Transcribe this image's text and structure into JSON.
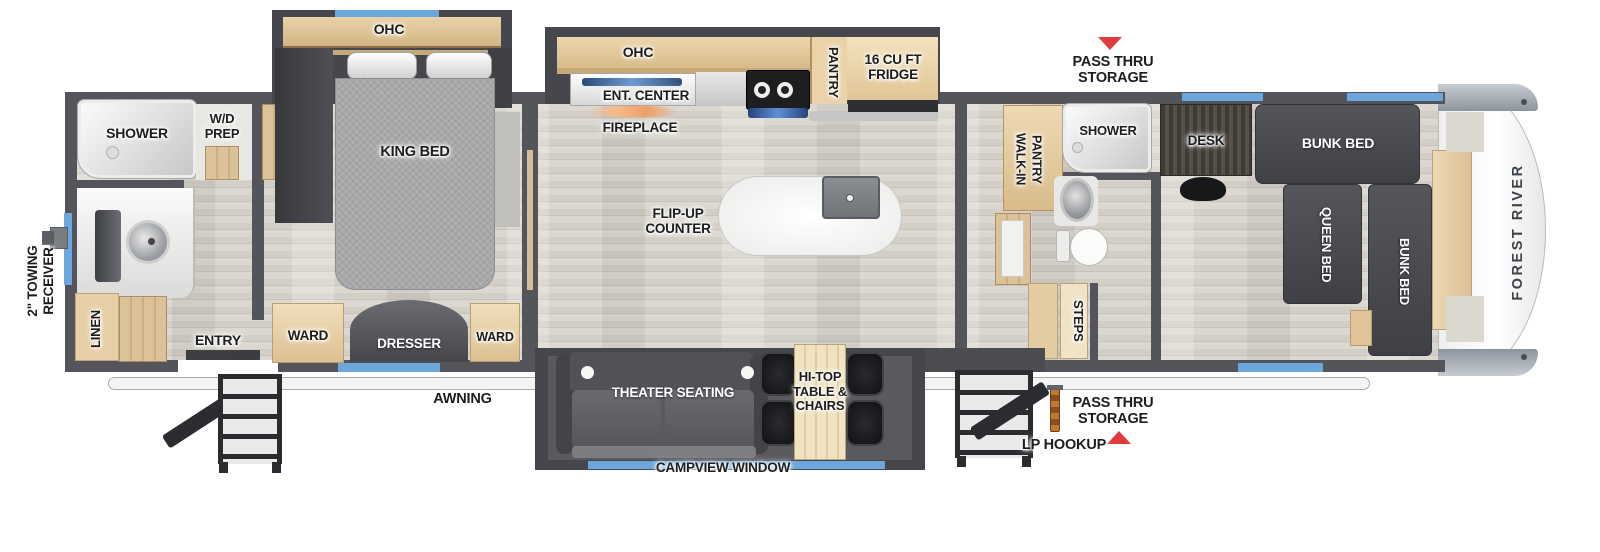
{
  "colors": {
    "wall_dark": "#54555a",
    "slide_dark": "#46474c",
    "floor_wood": "#d5d1c9",
    "cabinet_tan": "#e0c79d",
    "furniture_charcoal": "#4b4c51",
    "bed_gray": "#a8a8aa",
    "window_blue": "#6ba7dc",
    "marker_red": "#e23b3f",
    "counter_white": "#f5f5f3"
  },
  "exterior": {
    "towing_receiver": "2\" TOWING RECEIVER",
    "pass_thru_storage_top": "PASS THRU STORAGE",
    "pass_thru_storage_bottom": "PASS THRU STORAGE",
    "lp_hookup": "LP HOOKUP",
    "awning": "AWNING",
    "brand": "FOREST RIVER"
  },
  "rear_bath": {
    "shower": "SHOWER",
    "wd_prep": "W/D PREP",
    "linen": "LINEN",
    "entry": "ENTRY"
  },
  "bedroom": {
    "ohc": "OHC",
    "king_bed": "KING BED",
    "ward_left": "WARD",
    "dresser": "DRESSER",
    "ward_right": "WARD"
  },
  "kitchen": {
    "ohc": "OHC",
    "ent_center": "ENT. CENTER",
    "fireplace": "FIREPLACE",
    "pantry": "PANTRY",
    "fridge": "16 CU FT FRIDGE",
    "flip_up_counter": "FLIP-UP COUNTER"
  },
  "living": {
    "theater_seating": "THEATER SEATING",
    "hi_top_table": "HI-TOP TABLE & CHAIRS",
    "campview_window": "CAMPVIEW WINDOW"
  },
  "mid_bath": {
    "walk_in_pantry": "WALK-IN PANTRY",
    "shower": "SHOWER",
    "steps": "STEPS"
  },
  "bunk_room": {
    "desk": "DESK",
    "bunk_bed_top": "BUNK BED",
    "queen_bed": "QUEEN BED",
    "bunk_bed_right": "BUNK BED"
  }
}
